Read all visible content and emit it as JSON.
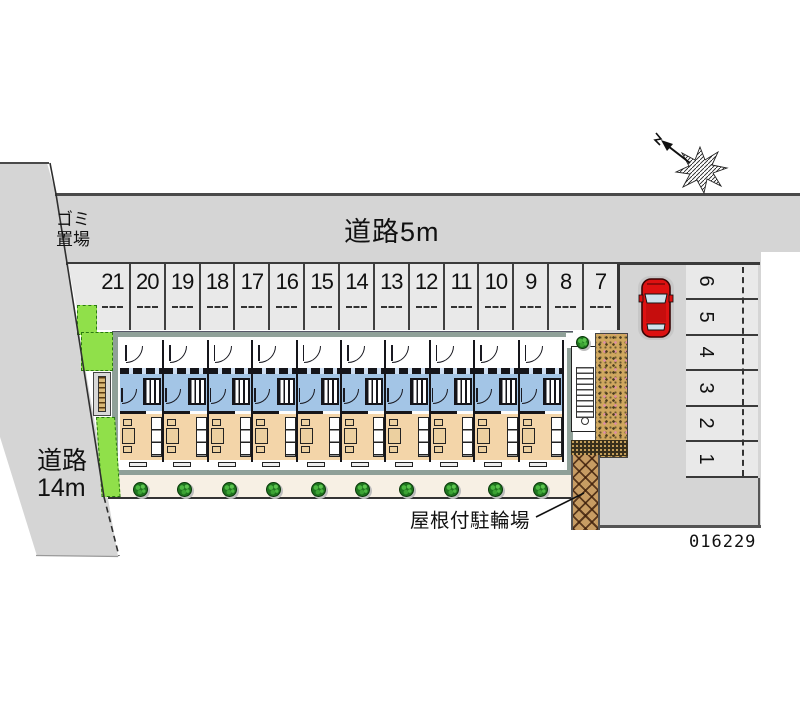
{
  "labels": {
    "road_top": "道路5m",
    "road_left_line1": "道路",
    "road_left_line2": "14m",
    "garbage_line1": "ゴミ",
    "garbage_line2": "置場",
    "covered_bicycle_parking": "屋根付駐輪場",
    "plan_number": "016229"
  },
  "parking": {
    "top_row_stalls": [
      "21",
      "20",
      "19",
      "18",
      "17",
      "16",
      "15",
      "14",
      "13",
      "12",
      "11",
      "10",
      "9",
      "8",
      "7"
    ],
    "right_column_stalls": [
      "6",
      "5",
      "4",
      "3",
      "2",
      "1"
    ]
  },
  "building": {
    "unit_count": 10,
    "bush_count": 10
  },
  "icons": {
    "north_arrow": "north-arrow-icon",
    "car": "car-icon",
    "bush": "bush-icon",
    "stairs": "stairs-icon",
    "bench": "bike-rack-icon"
  },
  "colors": {
    "road_gray": "#d5d5d5",
    "stall_gray": "#e9e9e9",
    "building_blue": "#a3c5e6",
    "building_tan": "#f3d5a9",
    "sage_border": "#8fa098",
    "walkway_cream": "#f7f0e4",
    "lawn_green": "#90e04a",
    "bush_green": "#1e741e",
    "brick_tan": "#cfa75f",
    "bike_brown": "#c79c63",
    "footing_dark": "#39301c",
    "car_red": "#dd1111"
  }
}
